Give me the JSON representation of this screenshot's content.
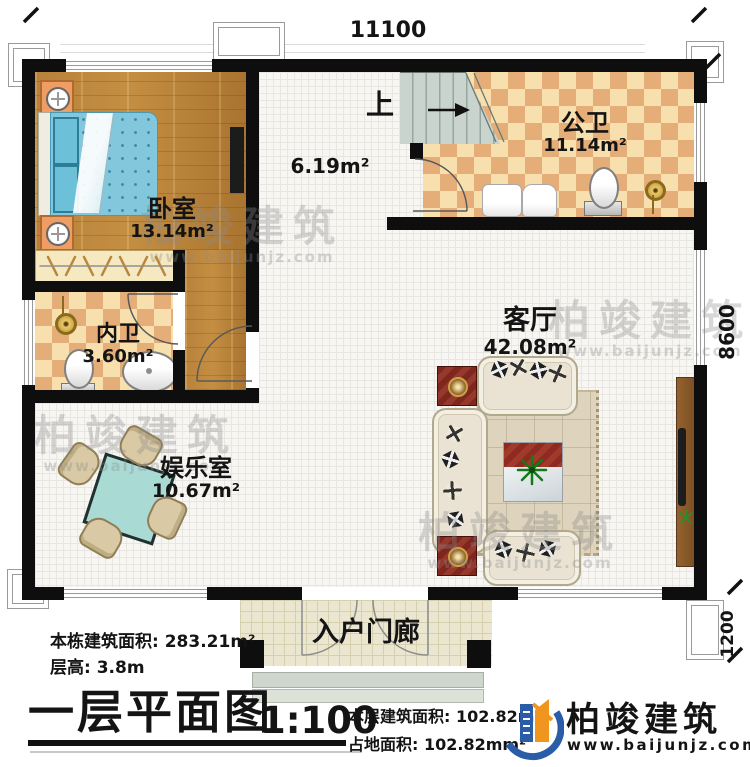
{
  "dimensions": {
    "width_top": "11100",
    "height_right": "8600",
    "porch_right": "1200"
  },
  "rooms": {
    "bedroom": {
      "label": "卧室",
      "area": "13.14m²"
    },
    "inner_bath": {
      "label": "内卫",
      "area": "3.60m²"
    },
    "entertainment": {
      "label": "娱乐室",
      "area": "10.67m²"
    },
    "public_bath": {
      "label": "公卫",
      "area": "11.14m²"
    },
    "living": {
      "label": "客厅",
      "area": "42.08m²"
    },
    "hall": {
      "area": "6.19m²"
    },
    "stairs": {
      "label": "上"
    },
    "porch": {
      "label": "入户门廊"
    }
  },
  "title_block": {
    "building_total_area": "本栋建筑面积: 283.21m²",
    "floor_height": "层高: 3.8m",
    "drawing_title": "一层平面图",
    "scale": "1:100",
    "floor_area": "本层建筑面积: 102.82m²",
    "land_area": "占地面积: 102.82mm²"
  },
  "brand": {
    "name": "柏竣建筑",
    "website": "www.baijunjz.com",
    "colors": {
      "blue": "#2a5ca8",
      "orange": "#f0961e"
    }
  },
  "watermark": {
    "text": "柏竣建筑",
    "website": "www.baijunjz.com"
  }
}
